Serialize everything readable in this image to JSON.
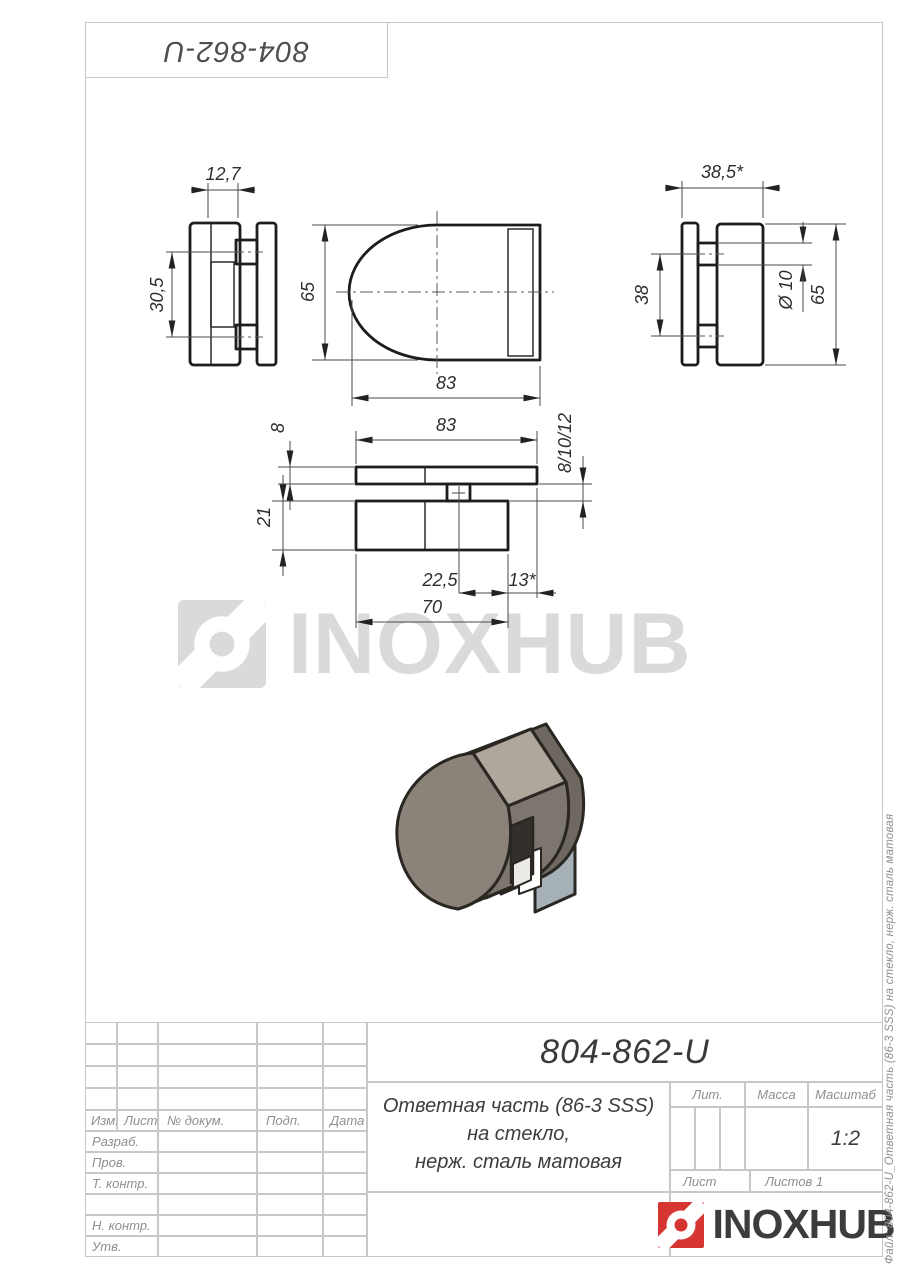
{
  "stamp_top": {
    "part_number": "804-862-U"
  },
  "watermark": {
    "brand": "INOXHUB"
  },
  "views": {
    "side_left": {
      "dim_width": "12,7",
      "dim_height": "30,5"
    },
    "front": {
      "dim_height": "65",
      "dim_width": "83"
    },
    "side_right": {
      "dim_width": "38,5*",
      "dim_bosses": "38",
      "dim_diameter": "Ø 10",
      "dim_height": "65"
    },
    "section": {
      "dim_plate": "8",
      "dim_width": "83",
      "dim_gap": "8/10/12",
      "dim_body": "21",
      "dim_offset": "22,5",
      "dim_lip": "13*",
      "dim_base": "70"
    }
  },
  "title_block": {
    "designation": "804-862-U",
    "description_line1": "Ответная часть (86-3 SSS)",
    "description_line2": "на стекло,",
    "description_line3": "нерж. сталь матовая",
    "headers": {
      "lit": "Лит.",
      "massa": "Масса",
      "masshtab": "Масштаб"
    },
    "scale": "1:2",
    "sheet_label": "Лист",
    "sheets_label": "Листов 1",
    "columns": {
      "izm": "Изм.",
      "list": "Лист",
      "n_dokum": "№ докум.",
      "podp": "Подп.",
      "data": "Дата"
    },
    "rows": {
      "razrab": "Разраб.",
      "prov": "Пров.",
      "t_kontr": "Т. контр.",
      "n_kontr": "Н. контр.",
      "utv": "Утв."
    },
    "logo_text": "INOXHUB"
  },
  "file_note": "Файл: 804-862-U_Ответная часть (86-3 SSS) на стекло, нерж. сталь матовая",
  "colors": {
    "logo_red": "#d63531",
    "line_dark": "#1d1d1d",
    "border_gray": "#c5c7c9",
    "watermark_gray": "#dadada",
    "part_front": "#8b8379",
    "part_top": "#b0a79c",
    "glass": "#a6b0b7"
  }
}
